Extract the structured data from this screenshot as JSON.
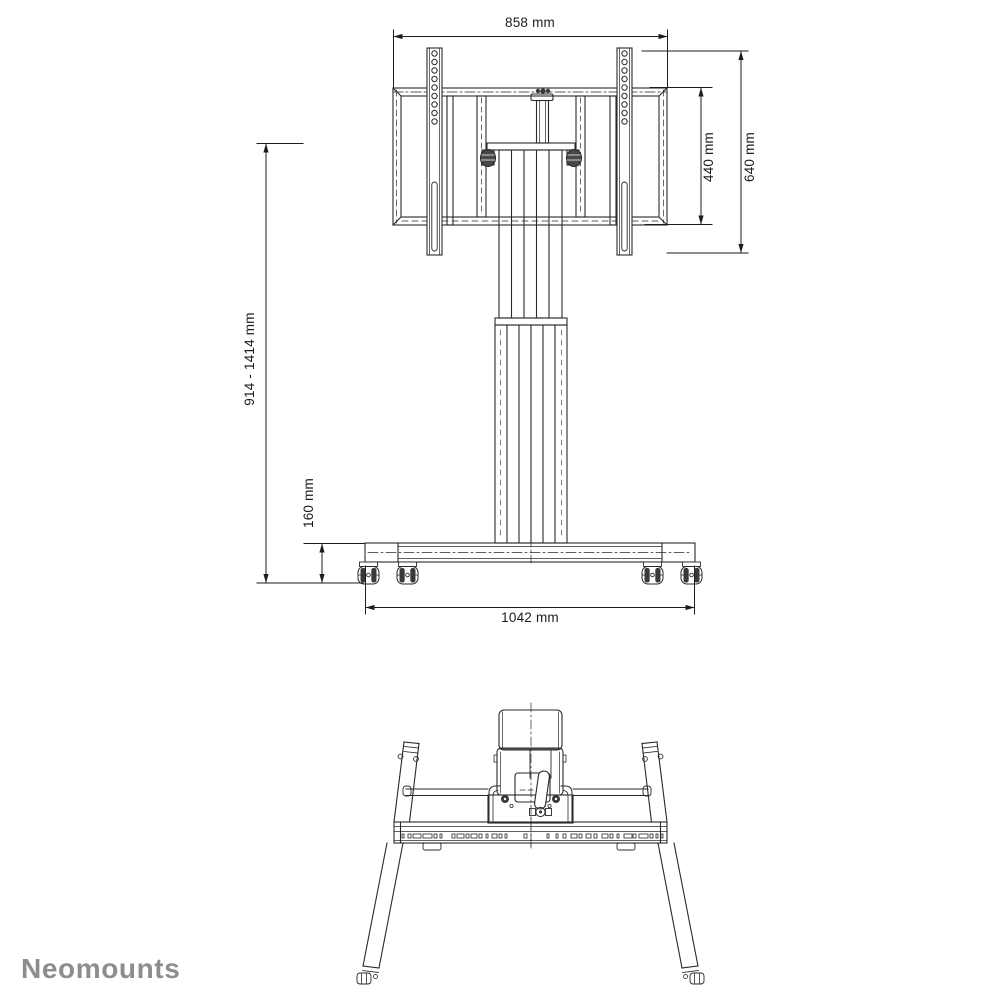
{
  "page": {
    "background": "#ffffff",
    "line_color": "#2b2a29",
    "dimension_text_color": "#1f1d1c"
  },
  "branding": {
    "logo_text": "Neomounts",
    "logo_color": "#8d8d8d"
  },
  "dimensions": {
    "bracket_width": "858 mm",
    "bracket_height": "440 mm",
    "mount_rail_height": "640 mm",
    "overall_height_range": "914 - 1414 mm",
    "base_height": "160 mm",
    "base_width": "1042 mm"
  }
}
